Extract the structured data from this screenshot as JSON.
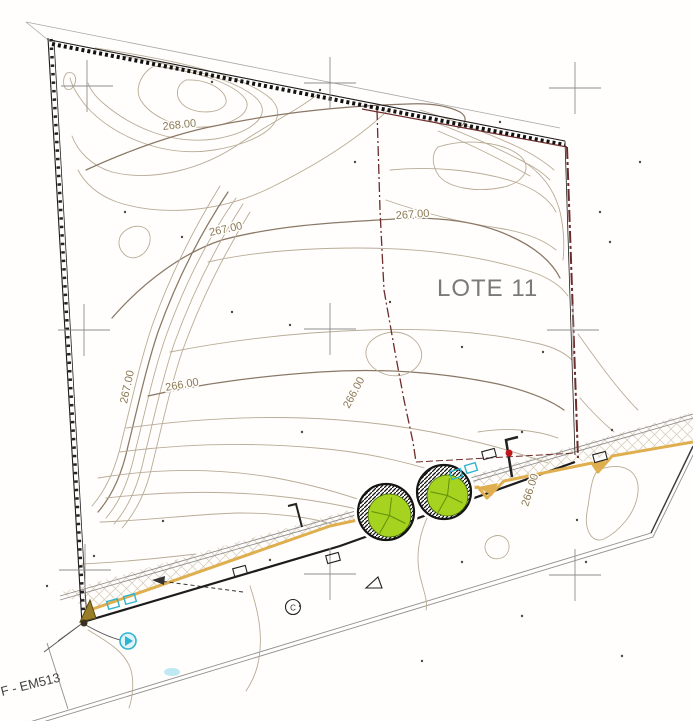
{
  "drawing": {
    "lot_label": "LOTE 11",
    "reference_label": "F - EM513",
    "circled_letter": "C",
    "contour_labels": [
      {
        "text": "268.00",
        "x": 163,
        "y": 130,
        "rot": -6
      },
      {
        "text": "267.00",
        "x": 210,
        "y": 236,
        "rot": -12
      },
      {
        "text": "267.00",
        "x": 396,
        "y": 219,
        "rot": -4
      },
      {
        "text": "267.00",
        "x": 127,
        "y": 404,
        "rot": -78
      },
      {
        "text": "266.00",
        "x": 166,
        "y": 391,
        "rot": -10
      },
      {
        "text": "266.00",
        "x": 349,
        "y": 409,
        "rot": -62
      },
      {
        "text": "266.00",
        "x": 528,
        "y": 507,
        "rot": -72
      }
    ],
    "survey_crosses": [
      [
        87,
        86
      ],
      [
        330,
        83
      ],
      [
        575,
        88
      ],
      [
        84,
        330
      ],
      [
        330,
        329
      ],
      [
        573,
        330
      ],
      [
        85,
        570
      ],
      [
        330,
        574
      ],
      [
        575,
        575
      ]
    ],
    "trees": [
      {
        "cx": 386,
        "cy": 512,
        "r": 28
      },
      {
        "cx": 444,
        "cy": 492,
        "r": 27
      }
    ],
    "cyan_boxes": [
      [
        113,
        604,
        -15
      ],
      [
        130,
        599,
        -15
      ],
      [
        456,
        474,
        -17
      ],
      [
        471,
        468,
        -17
      ]
    ],
    "black_boxes": [
      [
        489,
        454,
        -15
      ],
      [
        600,
        457,
        -15
      ],
      [
        240,
        571,
        -15
      ],
      [
        333,
        558,
        -15
      ]
    ],
    "red_dot": [
      509,
      453
    ],
    "cyan_circle": [
      128,
      641
    ],
    "point_dots": [
      [
        212,
        82
      ],
      [
        320,
        90
      ],
      [
        500,
        122
      ],
      [
        355,
        162
      ],
      [
        125,
        212
      ],
      [
        182,
        237
      ],
      [
        290,
        325
      ],
      [
        390,
        302
      ],
      [
        462,
        347
      ],
      [
        232,
        312
      ],
      [
        543,
        352
      ],
      [
        600,
        212
      ],
      [
        640,
        162
      ],
      [
        302,
        432
      ],
      [
        522,
        432
      ],
      [
        612,
        430
      ],
      [
        163,
        521
      ],
      [
        47,
        586
      ],
      [
        300,
        606
      ],
      [
        462,
        562
      ],
      [
        586,
        562
      ],
      [
        622,
        656
      ],
      [
        422,
        661
      ],
      [
        522,
        616
      ],
      [
        94,
        556
      ],
      [
        270,
        560
      ],
      [
        610,
        242
      ],
      [
        577,
        520
      ]
    ],
    "colors": {
      "contour_minor": "#b9ab97",
      "contour_index": "#8a7866",
      "label": "#8a7a55",
      "boundary_red": "#6d2c2c",
      "curb_orange": "#dfae4f",
      "tree_green": "#a5d31f",
      "utility_cyan": "#2fb4cf",
      "marker_red": "#c0181a",
      "cross_gray": "#8e8e8e",
      "lot_text": "#7a7a7a",
      "road_edge": "#8f8f8f",
      "hatch": "#d2c9b6"
    }
  }
}
